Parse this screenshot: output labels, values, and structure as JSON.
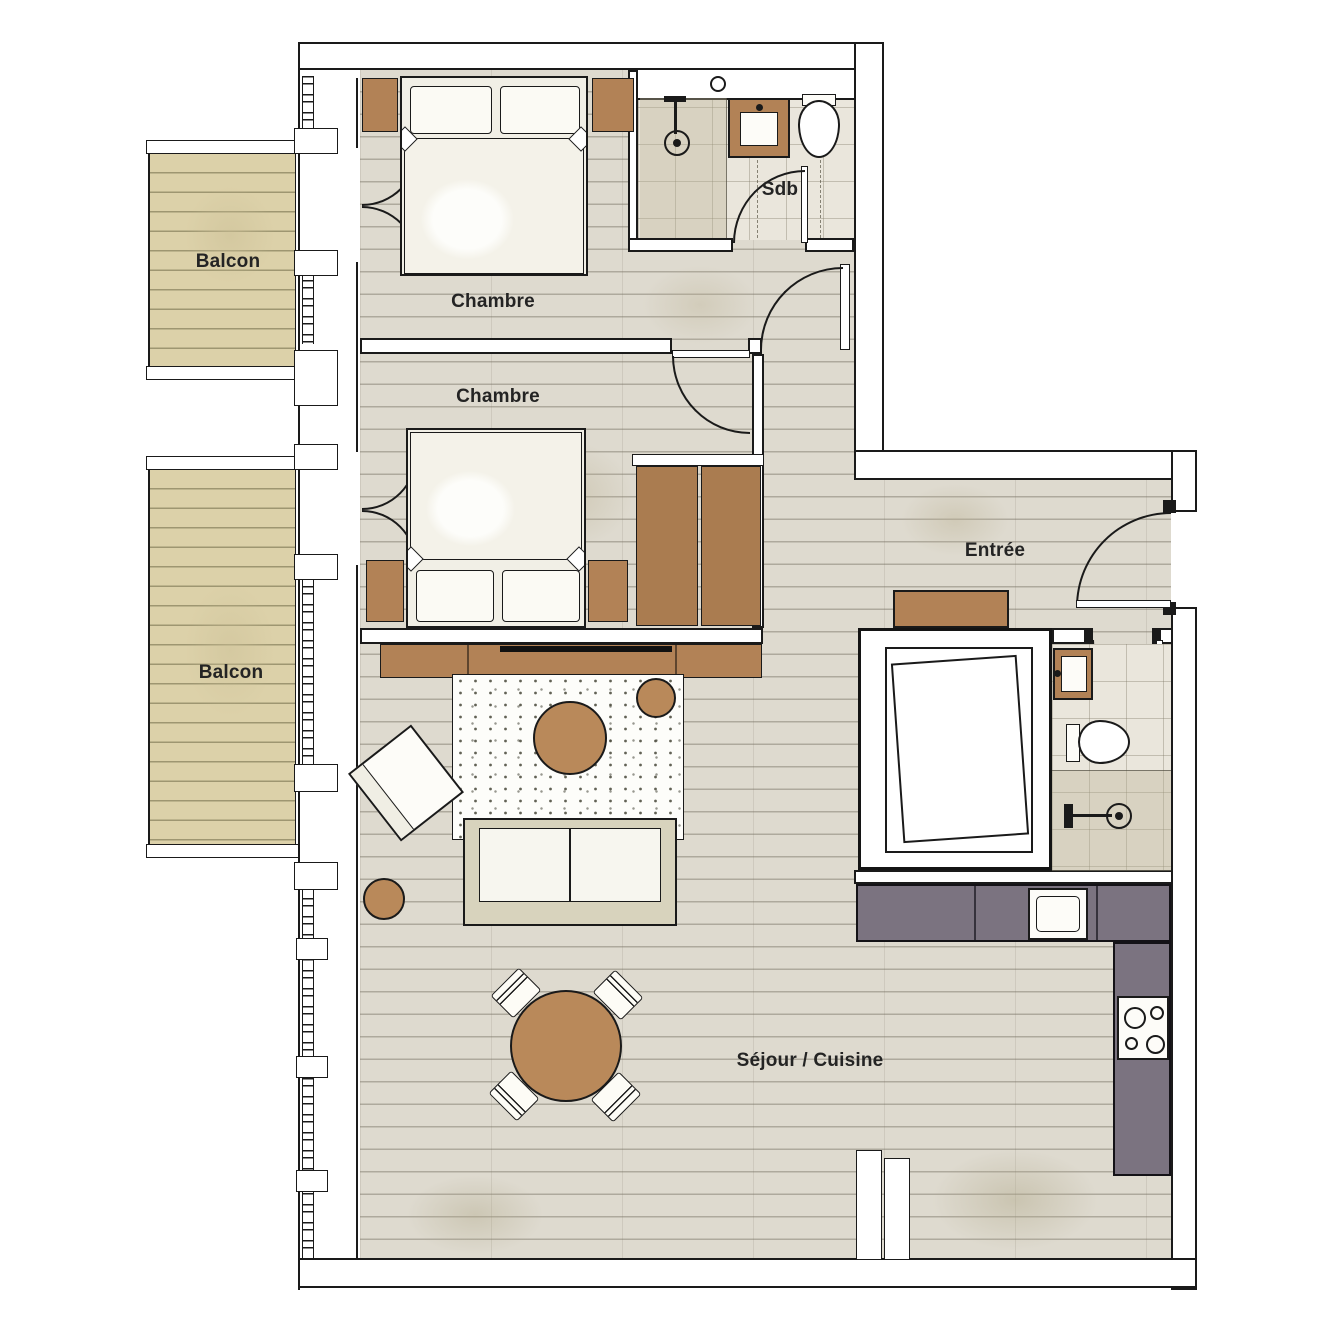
{
  "labels": {
    "balcony_top": "Balcon",
    "balcony_bottom": "Balcon",
    "bedroom_top": "Chambre",
    "bedroom_middle": "Chambre",
    "bathroom": "Sdb",
    "entry": "Entrée",
    "living_kitchen": "Séjour / Cuisine"
  },
  "colors": {
    "line": "#1a1a1a",
    "wood_furniture": "#b28256",
    "wardrobe_wood": "#aa7c50",
    "table_wood": "#b9895a",
    "kitchen_counter": "#7b7380",
    "plank_floor": "#dedacf",
    "tile_floor": "#eae6dc",
    "balcony_deck": "#dcd1a9",
    "sofa_frame": "#d8d3bd",
    "paper": "#ffffff"
  },
  "furniture_inventory": [
    "double-bed",
    "double-bed",
    "nightstands",
    "wardrobes",
    "tv-sideboard",
    "speckled-rug",
    "round-coffee-table",
    "round-side-table",
    "armchair",
    "pouf",
    "sofa",
    "round-dining-table",
    "dining-chairs",
    "entry-console",
    "closet-unit",
    "kitchen-l-counter",
    "kitchen-sink",
    "cooktop-4-burners",
    "shower",
    "washbasin",
    "toilet",
    "shower-2",
    "washbasin-2",
    "toilet-2"
  ]
}
